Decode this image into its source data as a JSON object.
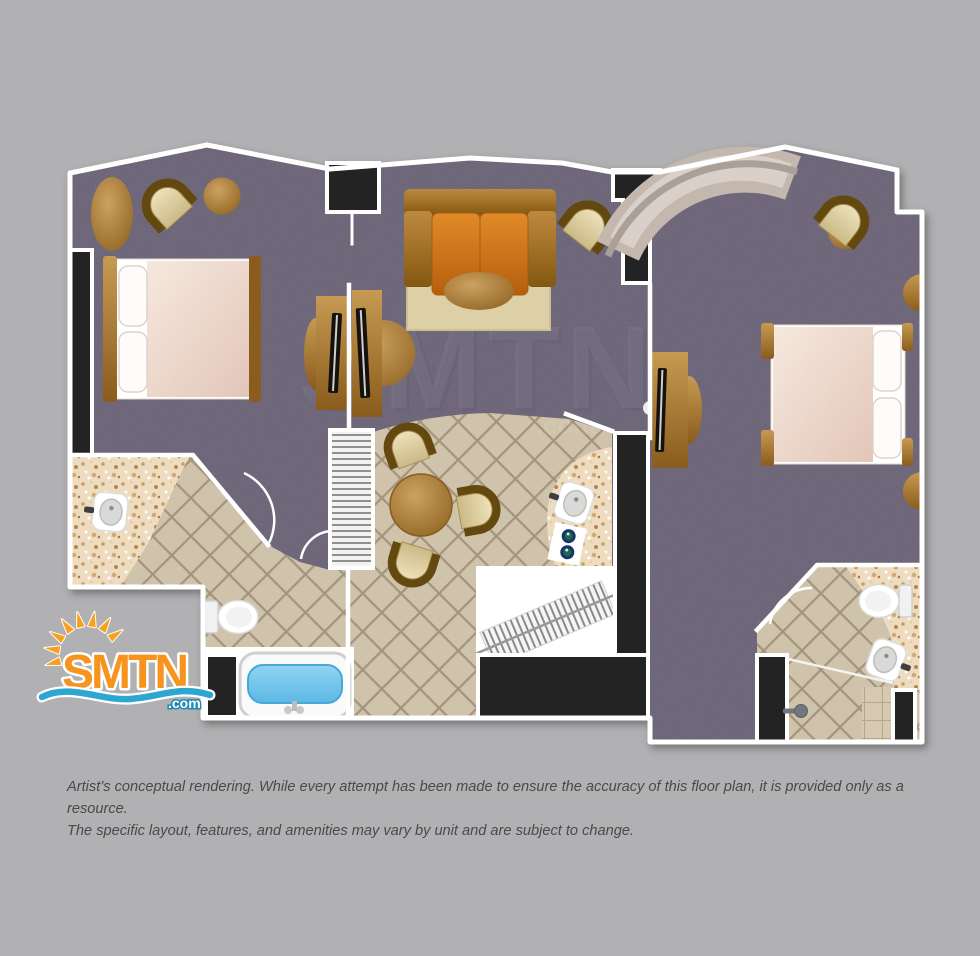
{
  "logo": {
    "brand": "SMTN",
    "tld": ".com"
  },
  "watermark": {
    "text": "SMTN",
    "tld": ".com"
  },
  "disclaimer": {
    "line1": "Artist’s conceptual rendering. While every attempt has been made to ensure the accuracy of this floor plan, it is provided only as a resource.",
    "line2": "The specific layout, features, and amenities may vary by unit and are subject to change."
  },
  "palette": {
    "background": "#b1b0b2",
    "carpet": "#696075",
    "tile": "#d0c3ab",
    "tile_grout": "#a5947d",
    "wall_black": "#232323",
    "wall_white": "#ffffff",
    "counter_speckle": "#eedcc0",
    "wood": "#a9772f",
    "sofa_orange": "#cd7620",
    "rug": "#ddd0a6",
    "bed_linen": "#f2ddd2",
    "chaise": "#c4b7ae",
    "tub_water": "#6ec6ec",
    "logo_orange": "#f7941d",
    "logo_blue": "#2ea7d0",
    "disclaimer_text": "#4a4a4a"
  },
  "floor_plan": {
    "items": [
      "bed",
      "pillows",
      "nightstand",
      "tv-console",
      "sofa",
      "area-rug",
      "coffee-table",
      "arc-chair",
      "ottoman",
      "side-table",
      "chaise-lounge",
      "dining-table",
      "dining-chair",
      "louvered-closet",
      "vanity-sink",
      "toilet",
      "bathtub",
      "shower",
      "double-sink-vanity"
    ]
  }
}
